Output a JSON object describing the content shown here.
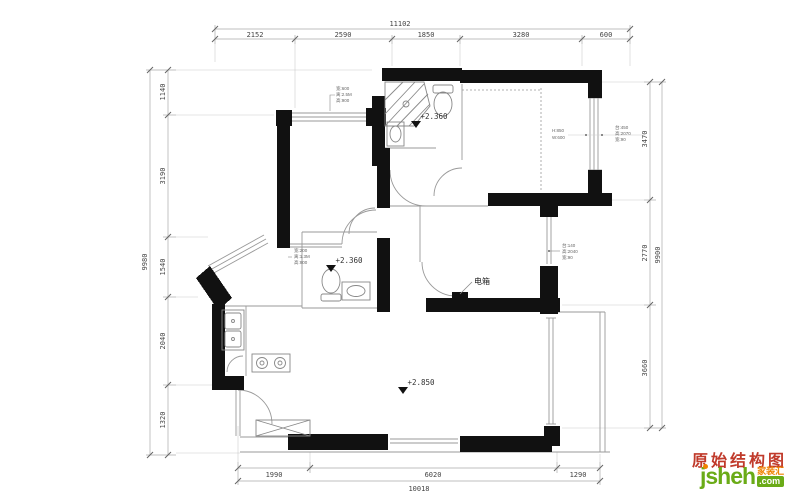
{
  "title": {
    "text": "原始结构图"
  },
  "logo": {
    "name": "jsheh",
    "tld": ".com",
    "badge": "家装汇"
  },
  "levels": {
    "bath_top": "+2.360",
    "bath_mid": "+2.360",
    "living": "+2.850"
  },
  "labels": {
    "electric_box": "电箱"
  },
  "colors": {
    "title_red": "#c03a2b",
    "logo_green": "#6aab17",
    "logo_orange": "#f08300",
    "wall_black": "#111111"
  },
  "dims": {
    "top": {
      "total": "11102",
      "segments": [
        "2152",
        "2590",
        "1850",
        "3280",
        "600"
      ]
    },
    "left": {
      "total": "9980",
      "segments": [
        "1140",
        "3190",
        "1540",
        "2040",
        "1320"
      ]
    },
    "right": {
      "total": "9900",
      "segments": [
        "3470",
        "2770",
        "3660"
      ]
    },
    "bottom": {
      "total": "10018",
      "segments": [
        "1990",
        "6020",
        "1290"
      ]
    }
  },
  "ann": {
    "win_tl": [
      "宽:600",
      "离:2.5M",
      "高:900"
    ],
    "win_bath2": [
      "宽:200",
      "离:1.3M",
      "高:900"
    ],
    "win_tr_a": [
      "H:850",
      "W:600"
    ],
    "win_tr_b": [
      "台:450",
      "高:2070",
      "宽:90"
    ],
    "win_mid": [
      "台:140",
      "高:2040",
      "宽:90"
    ]
  }
}
